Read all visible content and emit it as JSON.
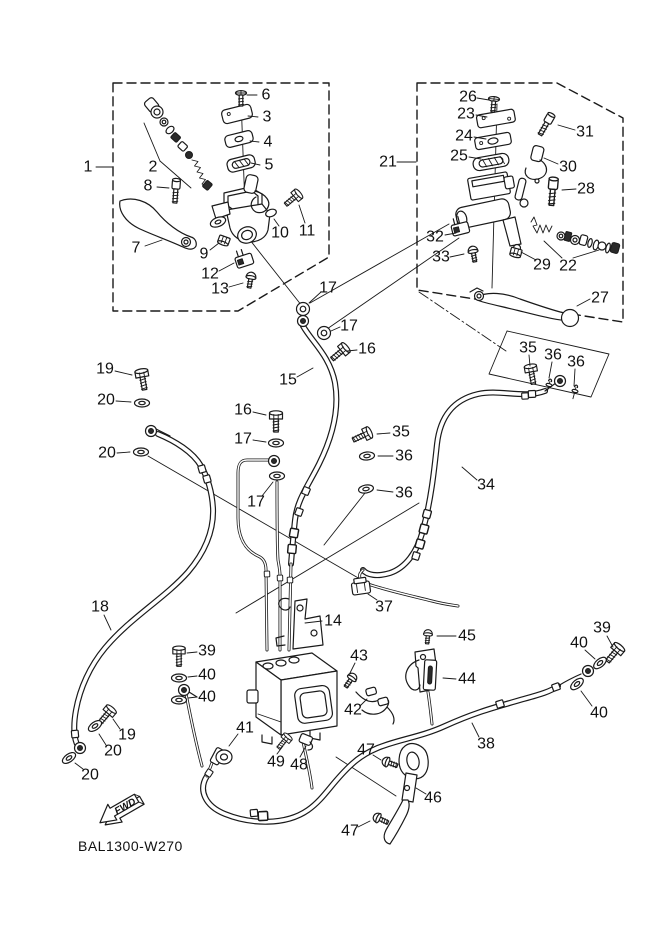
{
  "page": {
    "background": "#ffffff",
    "line_color": "#1a1a1a"
  },
  "part_code": "BAL1300-W270",
  "fwd_label": "FWD",
  "dash_boxes": [
    "113,83 329,83 329,257 238,311 113,311",
    "417,83 557,83 623,118 623,322 417,290"
  ],
  "solid_outlines": [
    "507,331 609,354 591,397 489,374"
  ],
  "construction_lines": [
    [
      241,
      98,
      246,
      235,
      "solid"
    ],
    [
      246,
      235,
      302,
      306,
      "solid"
    ],
    [
      497,
      104,
      492,
      288,
      "solid"
    ],
    [
      160,
      161,
      144,
      123,
      "solid"
    ],
    [
      160,
      161,
      191,
      188,
      "solid"
    ],
    [
      562,
      258,
      544,
      241,
      "solid"
    ],
    [
      573,
      258,
      599,
      250,
      "solid"
    ],
    [
      449,
      224,
      310,
      303,
      "solid"
    ],
    [
      459,
      238,
      327,
      329,
      "solid"
    ],
    [
      148,
      456,
      360,
      579,
      "solid"
    ],
    [
      419,
      503,
      236,
      613,
      "solid"
    ],
    [
      365,
      493,
      324,
      545,
      "solid"
    ],
    [
      336,
      757,
      396,
      796,
      "solid"
    ],
    [
      419,
      292,
      506,
      351,
      "dashdot"
    ]
  ],
  "fasteners": [
    {
      "t": "flatscrew",
      "x": 241,
      "y": 93,
      "r": 0,
      "name": "screw-6"
    },
    {
      "t": "capbolt",
      "x": 176,
      "y": 187,
      "r": 4,
      "name": "bolt-8"
    },
    {
      "t": "hexbolt",
      "x": 296,
      "y": 196,
      "r": 50,
      "s": 0.9,
      "name": "bolt-11"
    },
    {
      "t": "nut",
      "x": 224,
      "y": 240,
      "r": 20,
      "name": "nut-9"
    },
    {
      "t": "panscrew",
      "x": 251,
      "y": 277,
      "r": 10,
      "name": "screw-13"
    },
    {
      "t": "ring",
      "x": 303,
      "y": 309,
      "r": 0,
      "name": "washer-17-a"
    },
    {
      "t": "banjo",
      "x": 303,
      "y": 321,
      "r": 0,
      "name": "banjo-hose15-top"
    },
    {
      "t": "ring",
      "x": 324,
      "y": 333,
      "r": 0,
      "name": "washer-17-b"
    },
    {
      "t": "hexbolt",
      "x": 343,
      "y": 350,
      "r": 50,
      "s": 0.95,
      "name": "bolt-16-a"
    },
    {
      "t": "flatscrew",
      "x": 494,
      "y": 99,
      "r": 5,
      "name": "screw-26"
    },
    {
      "t": "capbolt",
      "x": 548,
      "y": 121,
      "r": 30,
      "name": "bolt-31"
    },
    {
      "t": "capbolt",
      "x": 553,
      "y": 187,
      "r": 5,
      "s": 1.15,
      "name": "bolt-28"
    },
    {
      "t": "nut",
      "x": 516,
      "y": 252,
      "r": 15,
      "name": "nut-29"
    },
    {
      "t": "panscrew",
      "x": 473,
      "y": 251,
      "r": -10,
      "name": "screw-33"
    },
    {
      "t": "hexbolt",
      "x": 142,
      "y": 375,
      "r": -10,
      "name": "bolt-19-a"
    },
    {
      "t": "washer",
      "x": 142,
      "y": 403,
      "r": 0,
      "name": "washer-20-a"
    },
    {
      "t": "banjo",
      "x": 151,
      "y": 431,
      "r": 0,
      "name": "banjo-hose18-top"
    },
    {
      "t": "washer",
      "x": 141,
      "y": 452,
      "r": 0,
      "name": "washer-20-b"
    },
    {
      "t": "hexbolt",
      "x": 276,
      "y": 417,
      "r": 0,
      "name": "bolt-16-b"
    },
    {
      "t": "washer",
      "x": 276,
      "y": 443,
      "r": 0,
      "name": "washer-17-c"
    },
    {
      "t": "banjo",
      "x": 274,
      "y": 461,
      "r": 0,
      "name": "banjo-center-pipe"
    },
    {
      "t": "washer",
      "x": 277,
      "y": 476,
      "r": 0,
      "name": "washer-17-d"
    },
    {
      "t": "hexbolt",
      "x": 531,
      "y": 370,
      "r": -10,
      "s": 0.95,
      "name": "bolt-35-a"
    },
    {
      "t": "pin",
      "x": 549,
      "y": 385,
      "r": 15,
      "name": "pin-36-a"
    },
    {
      "t": "pin",
      "x": 575,
      "y": 391,
      "r": 15,
      "name": "pin-36-b"
    },
    {
      "t": "banjo",
      "x": 560,
      "y": 381,
      "r": 0,
      "name": "banjo-hose34-top"
    },
    {
      "t": "hexbolt",
      "x": 366,
      "y": 434,
      "r": 65,
      "s": 0.95,
      "name": "bolt-35-b"
    },
    {
      "t": "washer",
      "x": 367,
      "y": 456,
      "r": -5,
      "name": "washer-36-c"
    },
    {
      "t": "washer",
      "x": 366,
      "y": 489,
      "r": -10,
      "name": "washer-36-d"
    },
    {
      "t": "hexbolt",
      "x": 179,
      "y": 652,
      "r": 0,
      "s": 0.95,
      "name": "bolt-39-a"
    },
    {
      "t": "washer",
      "x": 179,
      "y": 678,
      "r": 0,
      "name": "washer-40-a"
    },
    {
      "t": "banjo",
      "x": 184,
      "y": 690,
      "r": 0,
      "name": "banjo-40"
    },
    {
      "t": "washer",
      "x": 179,
      "y": 700,
      "r": 0,
      "name": "washer-40-b"
    },
    {
      "t": "hexbolt",
      "x": 109,
      "y": 712,
      "r": 40,
      "s": 0.95,
      "name": "bolt-19-b"
    },
    {
      "t": "washer",
      "x": 95,
      "y": 726,
      "r": -35,
      "name": "washer-20-c"
    },
    {
      "t": "banjo",
      "x": 80,
      "y": 748,
      "r": 0,
      "name": "banjo-hose18-end"
    },
    {
      "t": "washer",
      "x": 69,
      "y": 758,
      "r": -35,
      "name": "washer-20-d"
    },
    {
      "t": "hexbolt",
      "x": 617,
      "y": 650,
      "r": 40,
      "name": "bolt-39-b"
    },
    {
      "t": "washer",
      "x": 600,
      "y": 663,
      "r": -40,
      "name": "washer-40-c"
    },
    {
      "t": "banjo",
      "x": 588,
      "y": 671,
      "r": 0,
      "name": "banjo-hose38-end"
    },
    {
      "t": "washer",
      "x": 577,
      "y": 684,
      "r": -40,
      "name": "washer-40-d"
    },
    {
      "t": "hexbolt",
      "x": 286,
      "y": 739,
      "r": 40,
      "s": 0.8,
      "name": "bolt-49"
    },
    {
      "t": "panscrew",
      "x": 352,
      "y": 678,
      "r": 35,
      "name": "screw-43"
    },
    {
      "t": "panscrew",
      "x": 428,
      "y": 634,
      "r": 5,
      "s": 0.9,
      "name": "bolt-45"
    },
    {
      "t": "panscrew",
      "x": 387,
      "y": 762,
      "r": -70,
      "name": "screw-47-a"
    },
    {
      "t": "panscrew",
      "x": 378,
      "y": 818,
      "r": -65,
      "name": "screw-47-b"
    },
    {
      "t": "collar",
      "x": 306,
      "y": 491,
      "r": 113
    },
    {
      "t": "collar",
      "x": 299,
      "y": 512,
      "r": 110
    },
    {
      "t": "collar",
      "x": 294,
      "y": 533,
      "r": 100,
      "s": 1.2
    },
    {
      "t": "collar",
      "x": 292,
      "y": 549,
      "r": 95,
      "s": 1.2
    },
    {
      "t": "collar",
      "x": 202,
      "y": 469,
      "r": 74
    },
    {
      "t": "collar",
      "x": 207,
      "y": 479,
      "r": 74
    },
    {
      "t": "collar",
      "x": 75,
      "y": 734,
      "r": 85
    },
    {
      "t": "collar",
      "x": 532,
      "y": 394,
      "r": 177
    },
    {
      "t": "collar",
      "x": 525,
      "y": 396,
      "r": 177,
      "s": 0.9
    },
    {
      "t": "collar",
      "x": 427,
      "y": 514,
      "r": 105,
      "s": 1.1
    },
    {
      "t": "collar",
      "x": 424,
      "y": 529,
      "r": 105,
      "s": 1.2
    },
    {
      "t": "collar",
      "x": 420,
      "y": 544,
      "r": 106,
      "s": 1.2
    },
    {
      "t": "collar",
      "x": 416,
      "y": 556,
      "r": 107
    },
    {
      "t": "collar",
      "x": 263,
      "y": 816,
      "r": -3,
      "s": 1.3
    },
    {
      "t": "collar",
      "x": 254,
      "y": 813,
      "r": -5
    },
    {
      "t": "collar",
      "x": 500,
      "y": 704,
      "r": -17
    },
    {
      "t": "collar",
      "x": 556,
      "y": 687,
      "r": -20
    },
    {
      "t": "collar",
      "x": 209,
      "y": 773,
      "r": 123,
      "s": 0.9
    },
    {
      "t": "collar",
      "x": 267,
      "y": 574,
      "r": 88,
      "s": 0.8
    },
    {
      "t": "collar",
      "x": 280,
      "y": 578,
      "r": 88,
      "s": 0.8
    },
    {
      "t": "collar",
      "x": 290,
      "y": 580,
      "r": 88,
      "s": 0.8
    }
  ],
  "callouts": [
    {
      "n": "1",
      "x": 88,
      "y": 167,
      "l": [
        96,
        167,
        112,
        167
      ]
    },
    {
      "n": "2",
      "x": 153,
      "y": 167,
      "l": null
    },
    {
      "n": "3",
      "x": 267,
      "y": 117,
      "l": [
        258,
        117,
        248,
        116
      ]
    },
    {
      "n": "4",
      "x": 268,
      "y": 142,
      "l": [
        259,
        142,
        250,
        141
      ]
    },
    {
      "n": "5",
      "x": 269,
      "y": 165,
      "l": [
        260,
        165,
        251,
        163
      ]
    },
    {
      "n": "6",
      "x": 266,
      "y": 95,
      "l": [
        257,
        95,
        247,
        95
      ]
    },
    {
      "n": "7",
      "x": 136,
      "y": 248,
      "l": [
        145,
        246,
        162,
        240
      ]
    },
    {
      "n": "8",
      "x": 148,
      "y": 186,
      "l": [
        157,
        187,
        169,
        188
      ]
    },
    {
      "n": "9",
      "x": 204,
      "y": 254,
      "l": [
        210,
        250,
        219,
        243
      ]
    },
    {
      "n": "10",
      "x": 280,
      "y": 233,
      "l": [
        279,
        226,
        274,
        219
      ]
    },
    {
      "n": "11",
      "x": 307,
      "y": 231,
      "l": [
        305,
        223,
        299,
        205
      ]
    },
    {
      "n": "12",
      "x": 210,
      "y": 274,
      "l": [
        219,
        271,
        234,
        263
      ]
    },
    {
      "n": "13",
      "x": 220,
      "y": 289,
      "l": [
        229,
        287,
        243,
        283
      ]
    },
    {
      "n": "17",
      "x": 328,
      "y": 288,
      "l": [
        321,
        292,
        309,
        303
      ]
    },
    {
      "n": "21",
      "x": 388,
      "y": 162,
      "l": [
        397,
        162,
        416,
        162
      ]
    },
    {
      "n": "22",
      "x": 568,
      "y": 266,
      "l": null
    },
    {
      "n": "23",
      "x": 466,
      "y": 114,
      "l": [
        476,
        115,
        487,
        117
      ]
    },
    {
      "n": "24",
      "x": 464,
      "y": 136,
      "l": [
        474,
        137,
        486,
        139
      ]
    },
    {
      "n": "25",
      "x": 459,
      "y": 156,
      "l": [
        469,
        157,
        481,
        159
      ]
    },
    {
      "n": "26",
      "x": 468,
      "y": 97,
      "l": [
        477,
        98,
        489,
        100
      ]
    },
    {
      "n": "27",
      "x": 600,
      "y": 298,
      "l": [
        590,
        299,
        577,
        306
      ]
    },
    {
      "n": "28",
      "x": 586,
      "y": 189,
      "l": [
        576,
        189,
        562,
        190
      ]
    },
    {
      "n": "29",
      "x": 542,
      "y": 265,
      "l": [
        536,
        260,
        521,
        252
      ]
    },
    {
      "n": "30",
      "x": 568,
      "y": 167,
      "l": [
        558,
        164,
        544,
        158
      ]
    },
    {
      "n": "31",
      "x": 585,
      "y": 132,
      "l": [
        575,
        130,
        558,
        125
      ]
    },
    {
      "n": "32",
      "x": 435,
      "y": 237,
      "l": [
        445,
        235,
        456,
        233
      ]
    },
    {
      "n": "33",
      "x": 441,
      "y": 257,
      "l": [
        450,
        257,
        464,
        254
      ]
    },
    {
      "n": "15",
      "x": 288,
      "y": 380,
      "l": [
        297,
        377,
        313,
        368
      ]
    },
    {
      "n": "16",
      "x": 367,
      "y": 349,
      "l": [
        357,
        350,
        347,
        351
      ]
    },
    {
      "n": "17",
      "x": 349,
      "y": 326,
      "l": [
        340,
        327,
        331,
        331
      ]
    },
    {
      "n": "19",
      "x": 105,
      "y": 369,
      "l": [
        115,
        371,
        132,
        375
      ]
    },
    {
      "n": "20",
      "x": 106,
      "y": 400,
      "l": [
        116,
        401,
        131,
        402
      ]
    },
    {
      "n": "20",
      "x": 107,
      "y": 453,
      "l": [
        117,
        453,
        130,
        452
      ]
    },
    {
      "n": "16",
      "x": 243,
      "y": 410,
      "l": [
        253,
        412,
        266,
        415
      ]
    },
    {
      "n": "17",
      "x": 243,
      "y": 439,
      "l": [
        253,
        440,
        266,
        442
      ]
    },
    {
      "n": "17",
      "x": 256,
      "y": 502,
      "l": [
        262,
        496,
        273,
        482
      ]
    },
    {
      "n": "34",
      "x": 486,
      "y": 485,
      "l": [
        477,
        480,
        462,
        467
      ]
    },
    {
      "n": "35",
      "x": 528,
      "y": 348,
      "l": [
        529,
        355,
        530,
        366
      ]
    },
    {
      "n": "36",
      "x": 553,
      "y": 355,
      "l": [
        552,
        362,
        549,
        378
      ]
    },
    {
      "n": "36",
      "x": 576,
      "y": 362,
      "l": [
        575,
        369,
        574,
        386
      ]
    },
    {
      "n": "35",
      "x": 401,
      "y": 432,
      "l": [
        390,
        433,
        377,
        434
      ]
    },
    {
      "n": "36",
      "x": 404,
      "y": 456,
      "l": [
        393,
        456,
        378,
        456
      ]
    },
    {
      "n": "36",
      "x": 404,
      "y": 493,
      "l": [
        393,
        492,
        377,
        490
      ]
    },
    {
      "n": "37",
      "x": 384,
      "y": 607,
      "l": [
        377,
        600,
        368,
        594
      ]
    },
    {
      "n": "14",
      "x": 333,
      "y": 621,
      "l": [
        322,
        621,
        305,
        623
      ]
    },
    {
      "n": "18",
      "x": 100,
      "y": 607,
      "l": [
        104,
        615,
        111,
        630
      ]
    },
    {
      "n": "39",
      "x": 207,
      "y": 651,
      "l": [
        197,
        652,
        187,
        653
      ]
    },
    {
      "n": "40",
      "x": 207,
      "y": 675,
      "l": [
        197,
        676,
        188,
        677
      ]
    },
    {
      "n": "40",
      "x": 207,
      "y": 697,
      "l": [
        197,
        697,
        188,
        698
      ]
    },
    {
      "n": "19",
      "x": 127,
      "y": 735,
      "l": [
        120,
        729,
        113,
        719
      ]
    },
    {
      "n": "20",
      "x": 113,
      "y": 751,
      "l": [
        106,
        745,
        99,
        734
      ]
    },
    {
      "n": "20",
      "x": 90,
      "y": 775,
      "l": [
        83,
        769,
        75,
        763
      ]
    },
    {
      "n": "41",
      "x": 245,
      "y": 728,
      "l": [
        238,
        734,
        229,
        746
      ]
    },
    {
      "n": "49",
      "x": 276,
      "y": 762,
      "l": [
        277,
        754,
        283,
        746
      ]
    },
    {
      "n": "48",
      "x": 299,
      "y": 765,
      "l": [
        300,
        757,
        306,
        746
      ]
    },
    {
      "n": "43",
      "x": 359,
      "y": 656,
      "l": [
        355,
        663,
        350,
        673
      ]
    },
    {
      "n": "42",
      "x": 353,
      "y": 710,
      "l": [
        360,
        706,
        367,
        699
      ]
    },
    {
      "n": "45",
      "x": 467,
      "y": 636,
      "l": [
        456,
        636,
        437,
        636
      ]
    },
    {
      "n": "44",
      "x": 467,
      "y": 679,
      "l": [
        456,
        679,
        443,
        678
      ]
    },
    {
      "n": "39",
      "x": 602,
      "y": 628,
      "l": [
        607,
        636,
        613,
        647
      ]
    },
    {
      "n": "40",
      "x": 579,
      "y": 643,
      "l": [
        585,
        650,
        595,
        659
      ]
    },
    {
      "n": "40",
      "x": 599,
      "y": 713,
      "l": [
        592,
        706,
        581,
        691
      ]
    },
    {
      "n": "38",
      "x": 486,
      "y": 744,
      "l": [
        479,
        737,
        472,
        723
      ]
    },
    {
      "n": "47",
      "x": 366,
      "y": 750,
      "l": [
        373,
        755,
        381,
        760
      ]
    },
    {
      "n": "46",
      "x": 433,
      "y": 798,
      "l": [
        426,
        794,
        416,
        788
      ]
    },
    {
      "n": "47",
      "x": 350,
      "y": 831,
      "l": [
        358,
        827,
        370,
        821
      ]
    }
  ]
}
